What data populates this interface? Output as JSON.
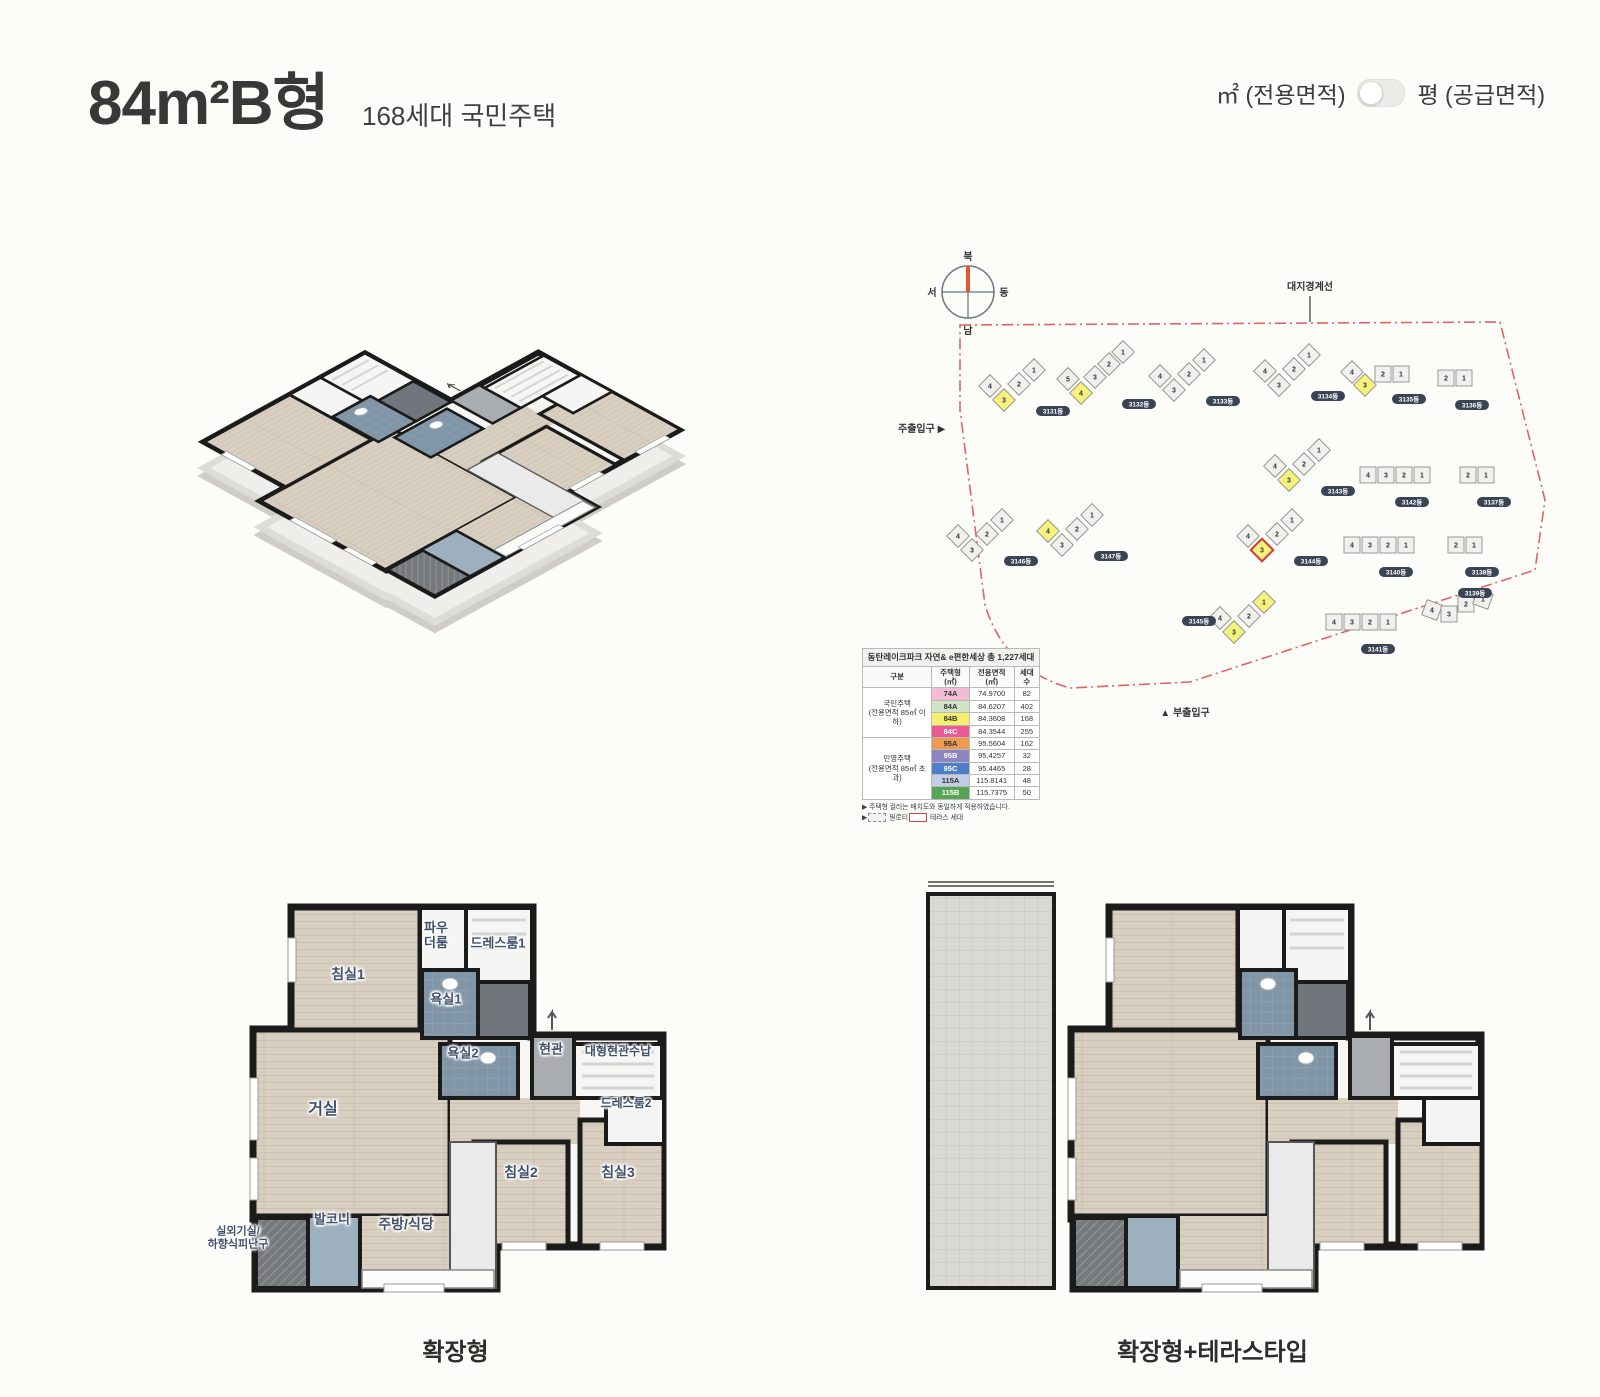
{
  "header": {
    "title": "84m²B형",
    "subtitle": "168세대 국민주택",
    "toggle": {
      "left_label": "㎡ (전용면적)",
      "right_label": "평 (공급면적)",
      "state": "left"
    }
  },
  "site_plan": {
    "compass": {
      "north": "북",
      "south": "남",
      "west": "서",
      "east": "동"
    },
    "boundary_label": "대지경계선",
    "main_entrance": "주출입구",
    "sub_entrance": "부출입구",
    "accent_colors": {
      "boundary": "#e06361",
      "highlight_unit": "#f6f07d",
      "terrace_outline": "#d23b3b"
    },
    "buildings": [
      {
        "label": "3131동",
        "type": "v4",
        "x": 100,
        "y": 150,
        "yellow": [
          "3"
        ],
        "red": []
      },
      {
        "label": "3132동",
        "type": "v5",
        "x": 178,
        "y": 145,
        "yellow": [
          "4"
        ],
        "red": []
      },
      {
        "label": "3133동",
        "type": "v4",
        "x": 270,
        "y": 140,
        "yellow": [],
        "red": []
      },
      {
        "label": "3134동",
        "type": "v4",
        "x": 375,
        "y": 135,
        "yellow": [],
        "red": []
      },
      {
        "label": "3135동",
        "type": "mix",
        "x": 462,
        "y": 140,
        "yellow": [
          "3"
        ],
        "red": []
      },
      {
        "label": "3136동",
        "type": "pair",
        "x": 556,
        "y": 148,
        "yellow": [],
        "red": []
      },
      {
        "label": "3143동",
        "type": "v4",
        "x": 385,
        "y": 230,
        "yellow": [
          "3"
        ],
        "red": []
      },
      {
        "label": "3142동",
        "type": "row4",
        "x": 478,
        "y": 245,
        "yellow": [],
        "red": []
      },
      {
        "label": "3137동",
        "type": "pair",
        "x": 578,
        "y": 245,
        "yellow": [],
        "red": []
      },
      {
        "label": "3146동",
        "type": "v4",
        "x": 68,
        "y": 300,
        "yellow": [],
        "red": []
      },
      {
        "label": "3147동",
        "type": "v4",
        "x": 158,
        "y": 295,
        "yellow": [
          "4"
        ],
        "red": []
      },
      {
        "label": "3144동",
        "type": "v4",
        "x": 358,
        "y": 300,
        "yellow": [
          "3"
        ],
        "red": [
          "3"
        ]
      },
      {
        "label": "3140동",
        "type": "row4",
        "x": 462,
        "y": 315,
        "yellow": [],
        "red": []
      },
      {
        "label": "3138동",
        "type": "pair",
        "x": 566,
        "y": 315,
        "yellow": [],
        "red": []
      },
      {
        "label": "3145동",
        "type": "v4",
        "x": 330,
        "y": 382,
        "yellow": [
          "1",
          "3"
        ],
        "red": [],
        "pill": "left"
      },
      {
        "label": "3141동",
        "type": "row4",
        "x": 444,
        "y": 392,
        "yellow": [],
        "red": []
      },
      {
        "label": "3139동",
        "type": "cluster4",
        "x": 542,
        "y": 372,
        "yellow": [],
        "red": []
      }
    ],
    "legend": {
      "title": "동탄레이크파크 자연& e편한세상  총 1,227세대",
      "headers": [
        "구분",
        "주택형(㎡)",
        "전용면적(㎡)",
        "세대수"
      ],
      "groups": [
        {
          "name": "국민주택",
          "sub": "(전용면적 85㎡ 이하)",
          "rows": [
            {
              "type": "74A",
              "area": "74.9700",
              "count": "82",
              "color": "#f2bdd3",
              "text": "#333333"
            },
            {
              "type": "84A",
              "area": "84.6207",
              "count": "402",
              "color": "#cfe5c8",
              "text": "#333333"
            },
            {
              "type": "84B",
              "area": "84.3608",
              "count": "168",
              "color": "#f5ee6e",
              "text": "#333333"
            },
            {
              "type": "84C",
              "area": "84.3544",
              "count": "255",
              "color": "#ea5b94",
              "text": "#ffffff"
            }
          ]
        },
        {
          "name": "민영주택",
          "sub": "(전용면적 85㎡ 초과)",
          "rows": [
            {
              "type": "95A",
              "area": "95.5604",
              "count": "162",
              "color": "#eb9a50",
              "text": "#333333"
            },
            {
              "type": "95B",
              "area": "95.4257",
              "count": "32",
              "color": "#8d85c0",
              "text": "#ffffff"
            },
            {
              "type": "95C",
              "area": "95.4465",
              "count": "28",
              "color": "#4d7fc9",
              "text": "#ffffff"
            },
            {
              "type": "115A",
              "area": "115.8141",
              "count": "48",
              "color": "#c3cce6",
              "text": "#333333"
            },
            {
              "type": "115B",
              "area": "115.7375",
              "count": "50",
              "color": "#55a556",
              "text": "#ffffff"
            }
          ]
        }
      ],
      "notes": {
        "note1": "주택형 컬러는 배치도와 동일하게 적용하였습니다.",
        "piloti": "필로티",
        "terrace": "테라스 세대"
      }
    }
  },
  "floorplan_left": {
    "caption": "확장형",
    "rooms": {
      "bedroom1": "침실1",
      "powder_line1": "파우",
      "powder_line2": "더룸",
      "dress1": "드레스룸1",
      "bath1": "욕실1",
      "bath2": "욕실2",
      "entry": "현관",
      "entry_storage": "대형현관수납",
      "dress2": "드레스룸2",
      "living": "거실",
      "bedroom2": "침실2",
      "bedroom3": "침실3",
      "balcony": "발코니",
      "kitchen": "주방/식당",
      "outdoor_line1": "실외기실/",
      "outdoor_line2": "하향식피난구"
    }
  },
  "floorplan_right": {
    "caption": "확장형+테라스타입"
  }
}
